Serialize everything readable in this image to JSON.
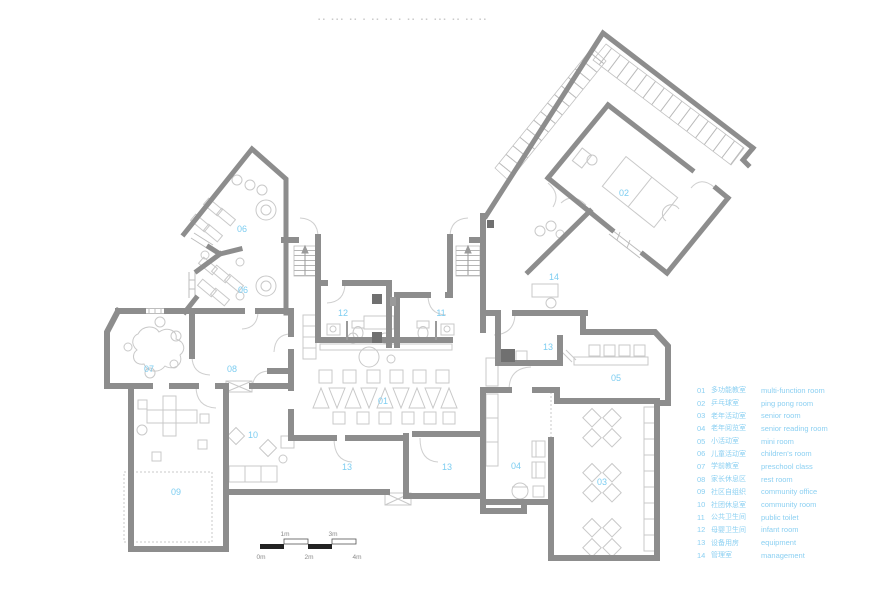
{
  "watermark": {
    "text": "▪▪ ▪▪▪ ▪▪ ▪ ▪▪ ▪▪ ▪ ▪▪ ▪▪ ▪▪▪ ▪▪ ▪▪ ▪▪"
  },
  "plan": {
    "colors": {
      "wall": "#8d8d8d",
      "furniture_outline": "#c9c9c9",
      "room_label": "#7dcdf1",
      "dark_fixture": "#707070",
      "scale_black": "#222222"
    },
    "room_labels": [
      {
        "text": "01"
      },
      {
        "text": "02"
      },
      {
        "text": "03"
      },
      {
        "text": "04"
      },
      {
        "text": "05"
      },
      {
        "text": "06"
      },
      {
        "text": "06"
      },
      {
        "text": "07"
      },
      {
        "text": "08"
      },
      {
        "text": "09"
      },
      {
        "text": "10"
      },
      {
        "text": "11"
      },
      {
        "text": "12"
      },
      {
        "text": "13"
      },
      {
        "text": "13"
      },
      {
        "text": "13"
      },
      {
        "text": "14"
      }
    ]
  },
  "legend": {
    "items": [
      {
        "num": "01",
        "zh": "多功能教室",
        "en": "multi-function room"
      },
      {
        "num": "02",
        "zh": "乒乓球室",
        "en": "ping pong room"
      },
      {
        "num": "03",
        "zh": "老年活动室",
        "en": "senior room"
      },
      {
        "num": "04",
        "zh": "老年阅览室",
        "en": "senior reading room"
      },
      {
        "num": "05",
        "zh": "小活动室",
        "en": "mini room"
      },
      {
        "num": "06",
        "zh": "儿童活动室",
        "en": "children's room"
      },
      {
        "num": "07",
        "zh": "学前教室",
        "en": "preschool class"
      },
      {
        "num": "08",
        "zh": "家长休息区",
        "en": "rest room"
      },
      {
        "num": "09",
        "zh": "社区自组织",
        "en": "community office"
      },
      {
        "num": "10",
        "zh": "社团休息室",
        "en": "community room"
      },
      {
        "num": "11",
        "zh": "公共卫生间",
        "en": "public toilet"
      },
      {
        "num": "12",
        "zh": "母婴卫生间",
        "en": "infant room"
      },
      {
        "num": "13",
        "zh": "设备用房",
        "en": "equipment"
      },
      {
        "num": "14",
        "zh": "管理室",
        "en": "management"
      }
    ]
  },
  "scale_bar": {
    "ticks": [
      "0m",
      "1m",
      "2m",
      "3m",
      "4m"
    ]
  }
}
